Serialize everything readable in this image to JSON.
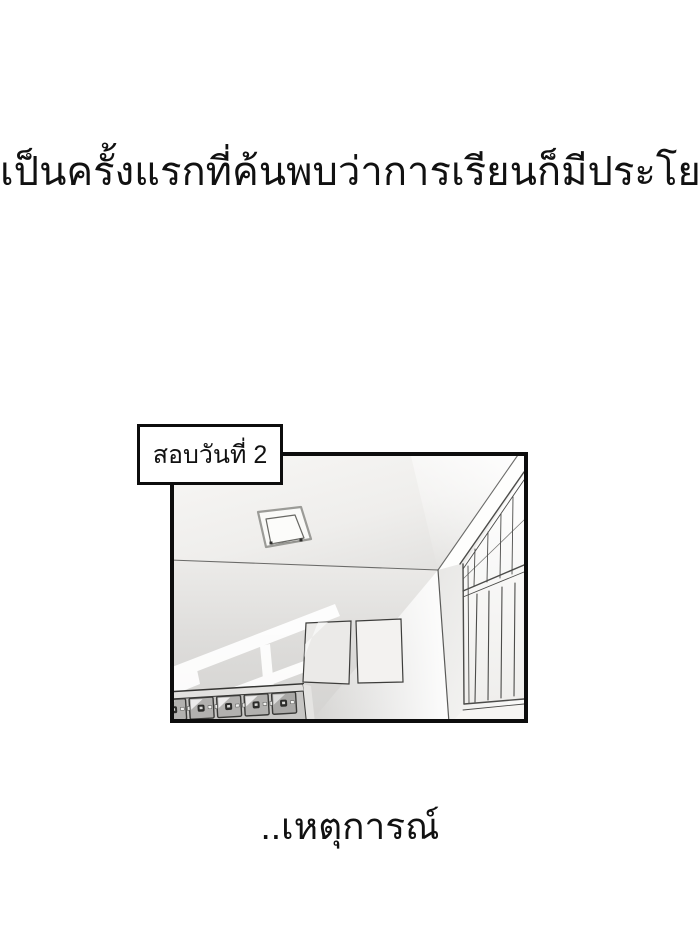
{
  "colors": {
    "paper": "#ffffff",
    "ink": "#111111",
    "panel_border": "#0d0d0d",
    "wall_gray": "#d9d8d6",
    "ceiling_gray": "#f3f2f0",
    "locker_gray": "#b2b1af",
    "sunlight": "#ffffff"
  },
  "captions": {
    "top": "เป็นครั้งแรกที่ค้นพบว่าการเรียนก็มีประโยชน์",
    "bottom": "..เหตุการณ์"
  },
  "panel": {
    "label": "สอบวันที่ 2"
  }
}
